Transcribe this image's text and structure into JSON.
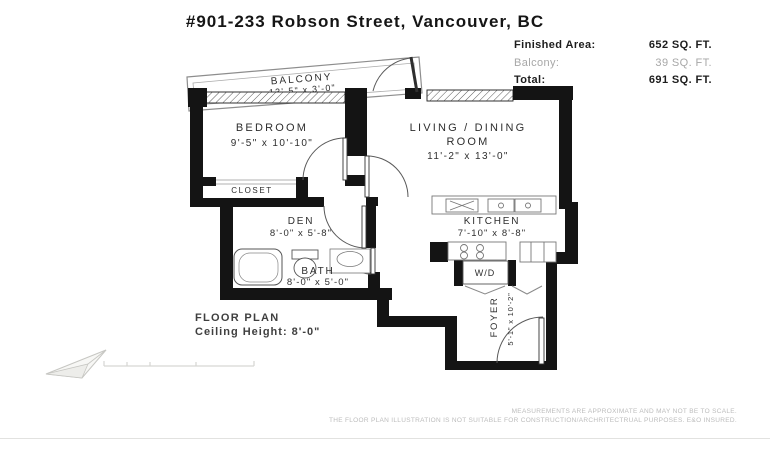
{
  "header": {
    "title": "#901-233 Robson Street, Vancouver, BC",
    "areas": [
      {
        "label": "Finished Area:",
        "value": "652 SQ. FT."
      },
      {
        "label": "Balcony:",
        "value": "39 SQ. FT."
      },
      {
        "label": "Total:",
        "value": "691 SQ. FT."
      }
    ]
  },
  "rooms": {
    "balcony": {
      "name": "BALCONY",
      "dims": "13'-5\" x 3'-0\""
    },
    "bedroom": {
      "name": "BEDROOM",
      "dims": "9'-5\" x 10'-10\""
    },
    "living": {
      "name_line1": "LIVING / DINING",
      "name_line2": "ROOM",
      "dims": "11'-2\" x 13'-0\""
    },
    "closet": {
      "name": "CLOSET"
    },
    "den": {
      "name": "DEN",
      "dims": "8'-0\" x 5'-8\""
    },
    "bath": {
      "name": "BATH",
      "dims": "8'-0\" x 5'-0\""
    },
    "kitchen": {
      "name": "KITCHEN",
      "dims": "7'-10\" x 8'-8\""
    },
    "wd": {
      "name": "W/D"
    },
    "foyer": {
      "name": "FOYER",
      "dims": "5'-1\" x 10'-2\""
    }
  },
  "footer": {
    "plan_label": "FLOOR PLAN",
    "ceiling": "Ceiling Height: 8'-0\"",
    "disclaimer_line1": "MEASUREMENTS ARE APPROXIMATE AND MAY NOT BE TO SCALE.",
    "disclaimer_line2": "THE FLOOR PLAN ILLUSTRATION IS NOT SUITABLE FOR CONSTRUCTION/ARCHRITECTRUAL PURPOSES. E&O INSURED."
  },
  "colors": {
    "wall": "#141414",
    "label_text": "#2e2e2e",
    "muted_text": "#a7a7a7",
    "faint_text": "#bcbcbc",
    "thin_line": "#777777"
  }
}
